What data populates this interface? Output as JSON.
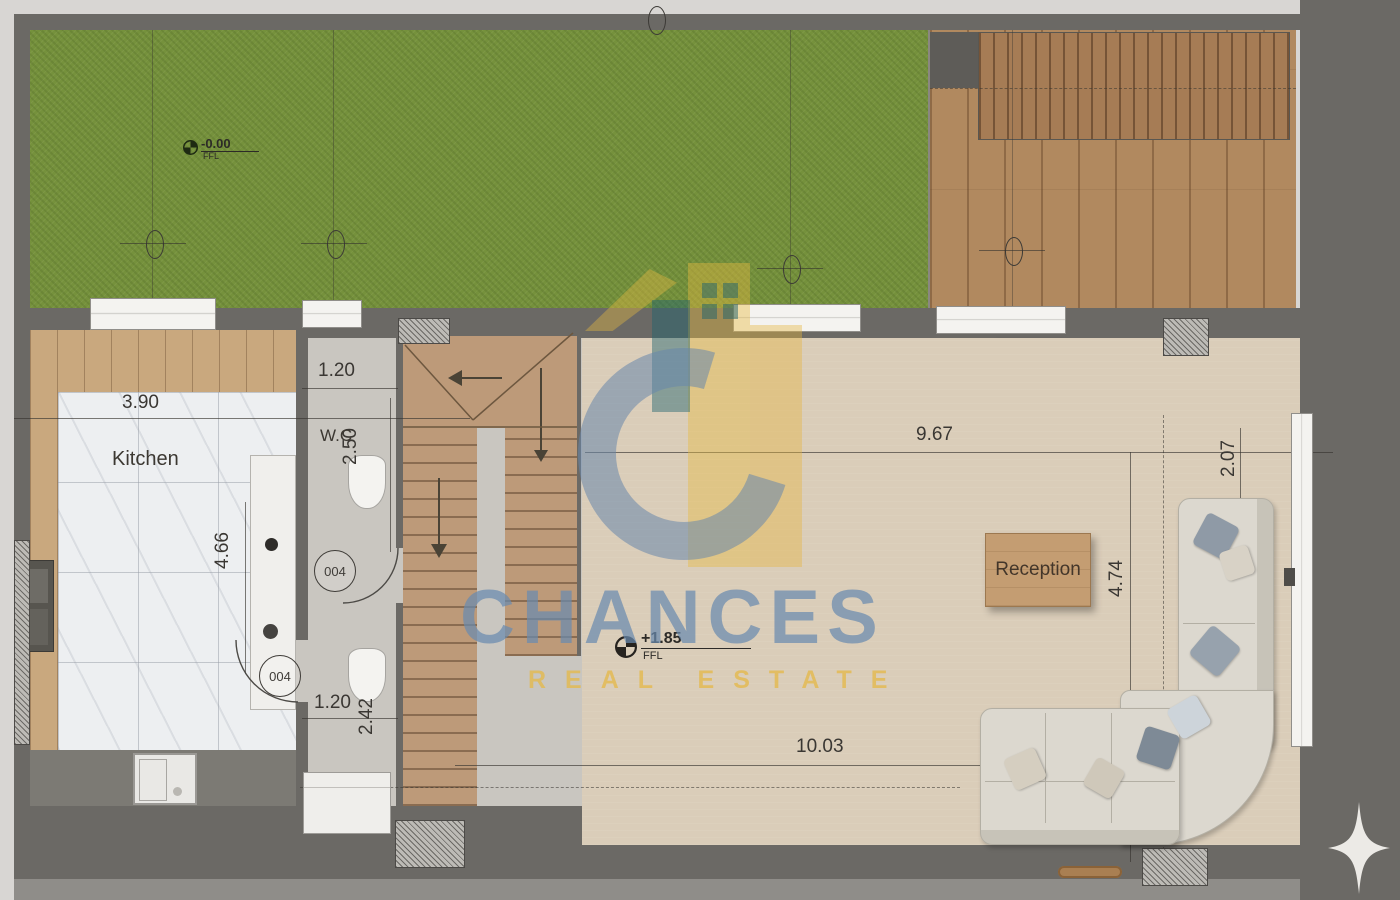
{
  "brand": {
    "name": "CHANCES",
    "tagline": "REAL ESTATE",
    "blue": "#6f94bd",
    "gold": "#e3b94d"
  },
  "rooms": {
    "kitchen": "Kitchen",
    "wc": "W.C",
    "reception": "Reception"
  },
  "dimensions": {
    "kitchen_width": "3.90",
    "kitchen_depth": "4.66",
    "wc_width_top": "1.20",
    "wc_depth": "2.50",
    "hall_width": "1.20",
    "hall_depth": "2.42",
    "reception_width_top": "9.67",
    "reception_width_bottom": "10.03",
    "reception_depth": "4.74",
    "sofa_bay_depth": "2.07"
  },
  "levels": {
    "garden": {
      "value": "-0.00",
      "unit": "FFL"
    },
    "reception": {
      "value": "+1.85",
      "unit": "FFL"
    }
  },
  "door_tags": {
    "wc_door": "004",
    "kitchen_door": "004"
  },
  "colors": {
    "grass": "#75913c",
    "deck_wood": "#b1895f",
    "wall": "#6b6965",
    "reception_floor": "#dacdb9",
    "marble": "#edeff1"
  }
}
